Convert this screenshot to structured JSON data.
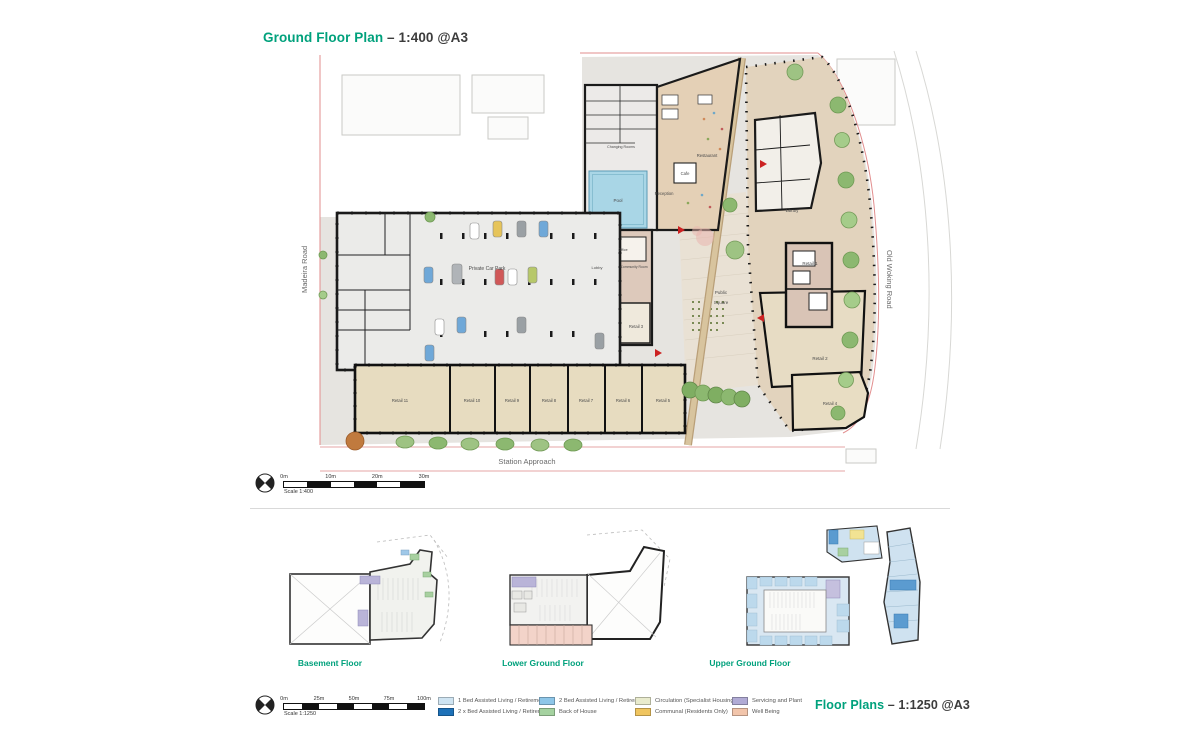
{
  "header": {
    "title_highlight": "Ground Floor Plan",
    "title_rest": " – 1:400 @A3"
  },
  "footer": {
    "title_highlight": "Floor Plans",
    "title_rest": " – 1:1250 @A3"
  },
  "colors": {
    "accent_teal": "#00a17c",
    "site_boundary_red": "#e28e8e",
    "pool_blue": "#a9d6e6",
    "building_tan": "#e4d0b6",
    "building_grey": "#ebebe9"
  },
  "main_plan": {
    "roads": {
      "left": "Madeira Road",
      "right": "Old Woking Road",
      "bottom": "Station Approach"
    },
    "rooms": {
      "private_car_park": "Private Car Park",
      "pool": "Pool",
      "changing_rooms": "Changing Rooms",
      "restaurant": "Restaurant",
      "cafe": "Cafe",
      "reception": "Reception",
      "lobby": "Lobby",
      "office": "Office",
      "community_room": "Community Room",
      "library": "Library",
      "public_square_1": "Public",
      "public_square_2": "Square",
      "retail_1": "Retail 1",
      "retail_2": "Retail 2",
      "retail_3": "Retail 3",
      "retail_4": "Retail 4",
      "retail_5": "Retail 5",
      "retail_6": "Retail 6",
      "retail_7": "Retail 7",
      "retail_8": "Retail 8",
      "retail_9": "Retail 9",
      "retail_10": "Retail 10",
      "retail_11": "Retail 11"
    },
    "scale": {
      "ticks": [
        "0m",
        "10m",
        "20m",
        "30m"
      ],
      "caption": "Scale 1:400"
    }
  },
  "floor_plans": {
    "basement": "Basement Floor",
    "lower_ground": "Lower Ground Floor",
    "upper_ground": "Upper Ground Floor"
  },
  "legend": {
    "scale": {
      "ticks": [
        "0m",
        "25m",
        "50m",
        "75m",
        "100m"
      ],
      "caption": "Scale 1:1250"
    },
    "items": [
      {
        "label": "1 Bed Assisted Living / Retirement",
        "color": "#cfe4f2"
      },
      {
        "label": "2 x Bed Assisted Living / Retirement",
        "color": "#1d71b8"
      },
      {
        "label": "2 Bed Assisted Living / Retirement",
        "color": "#8ec6e8"
      },
      {
        "label": "Back of House",
        "color": "#a5d2a0"
      },
      {
        "label": "Circulation (Specialist Housing)",
        "color": "#e9ebcd"
      },
      {
        "label": "Communal (Residents Only)",
        "color": "#f0c55f"
      },
      {
        "label": "Servicing and Plant",
        "color": "#b1abd5"
      },
      {
        "label": "Well Being",
        "color": "#f2c5ab"
      }
    ]
  }
}
